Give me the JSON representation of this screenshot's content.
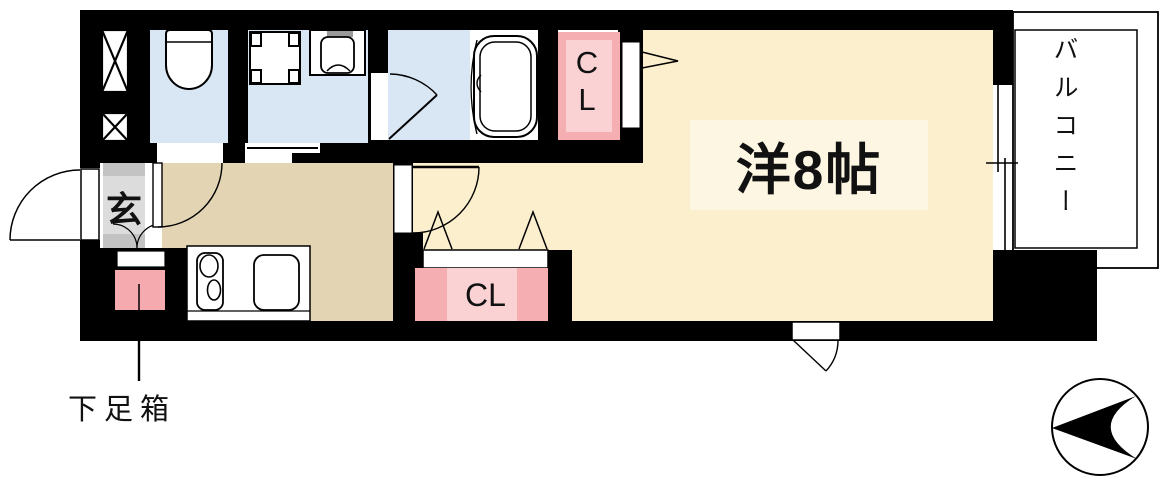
{
  "plan": {
    "entrance": {
      "label": "玄"
    },
    "shoe_box": {
      "label": "下足箱"
    },
    "closet_top": {
      "label": "CL"
    },
    "closet_bottom": {
      "label": "CL"
    },
    "main_room": {
      "label": "洋8帖"
    },
    "balcony": {
      "label": "バルコニー"
    }
  },
  "colors": {
    "wall": "#000000",
    "wet_area_floor": "#d9e7f5",
    "kitchen_floor": "#e3d5b3",
    "main_room_floor": "#fcefcd",
    "main_room_label_box": "#fdf6e3",
    "closet_pink": "#f5aeb2",
    "closet_pink_light": "#fad2d4",
    "shoe_box_pink": "#f5aab0",
    "entrance_gray": "#dcdcdc"
  }
}
